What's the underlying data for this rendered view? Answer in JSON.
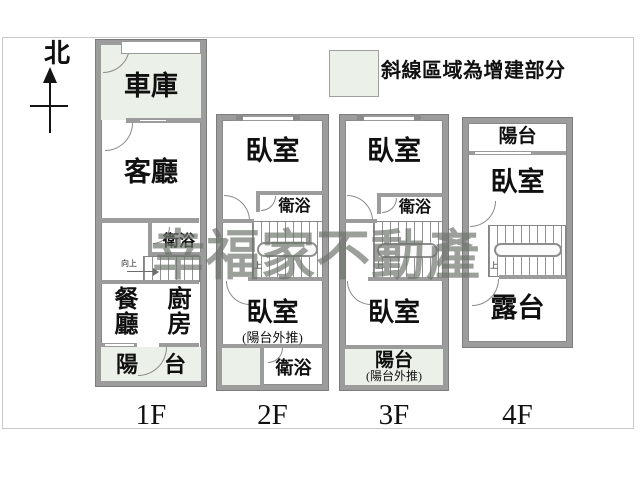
{
  "compass": {
    "label": "北"
  },
  "legend": {
    "text": "斜線區域為增建部分"
  },
  "watermark": {
    "text": "幸福家不動產"
  },
  "colors": {
    "wall": "#9c9c9c",
    "addition": "#ebf1e8",
    "frame": "#c8c8c8",
    "line": "#8a8a8a",
    "watermark": "#6e746c"
  },
  "f1": {
    "label": "1F",
    "garage": "車庫",
    "living": "客廳",
    "bath": "衛浴",
    "stairs_note": "向上",
    "dining": "餐廳",
    "kitchen": "廚房",
    "balcony": "陽台"
  },
  "f2": {
    "label": "2F",
    "bedroom_upper": "臥室",
    "bath_upper": "衛浴",
    "stairs_note": "上",
    "bedroom_lower": "臥室",
    "bedroom_note": "(陽台外推)",
    "bath_lower": "衛浴"
  },
  "f3": {
    "label": "3F",
    "bedroom_upper": "臥室",
    "bath_upper": "衛浴",
    "stairs_note": "上",
    "bedroom_lower": "臥室",
    "balcony": "陽台",
    "balcony_note": "(陽台外推)"
  },
  "f4": {
    "label": "4F",
    "balcony": "陽台",
    "bedroom": "臥室",
    "stairs_note": "上",
    "terrace": "露台"
  }
}
